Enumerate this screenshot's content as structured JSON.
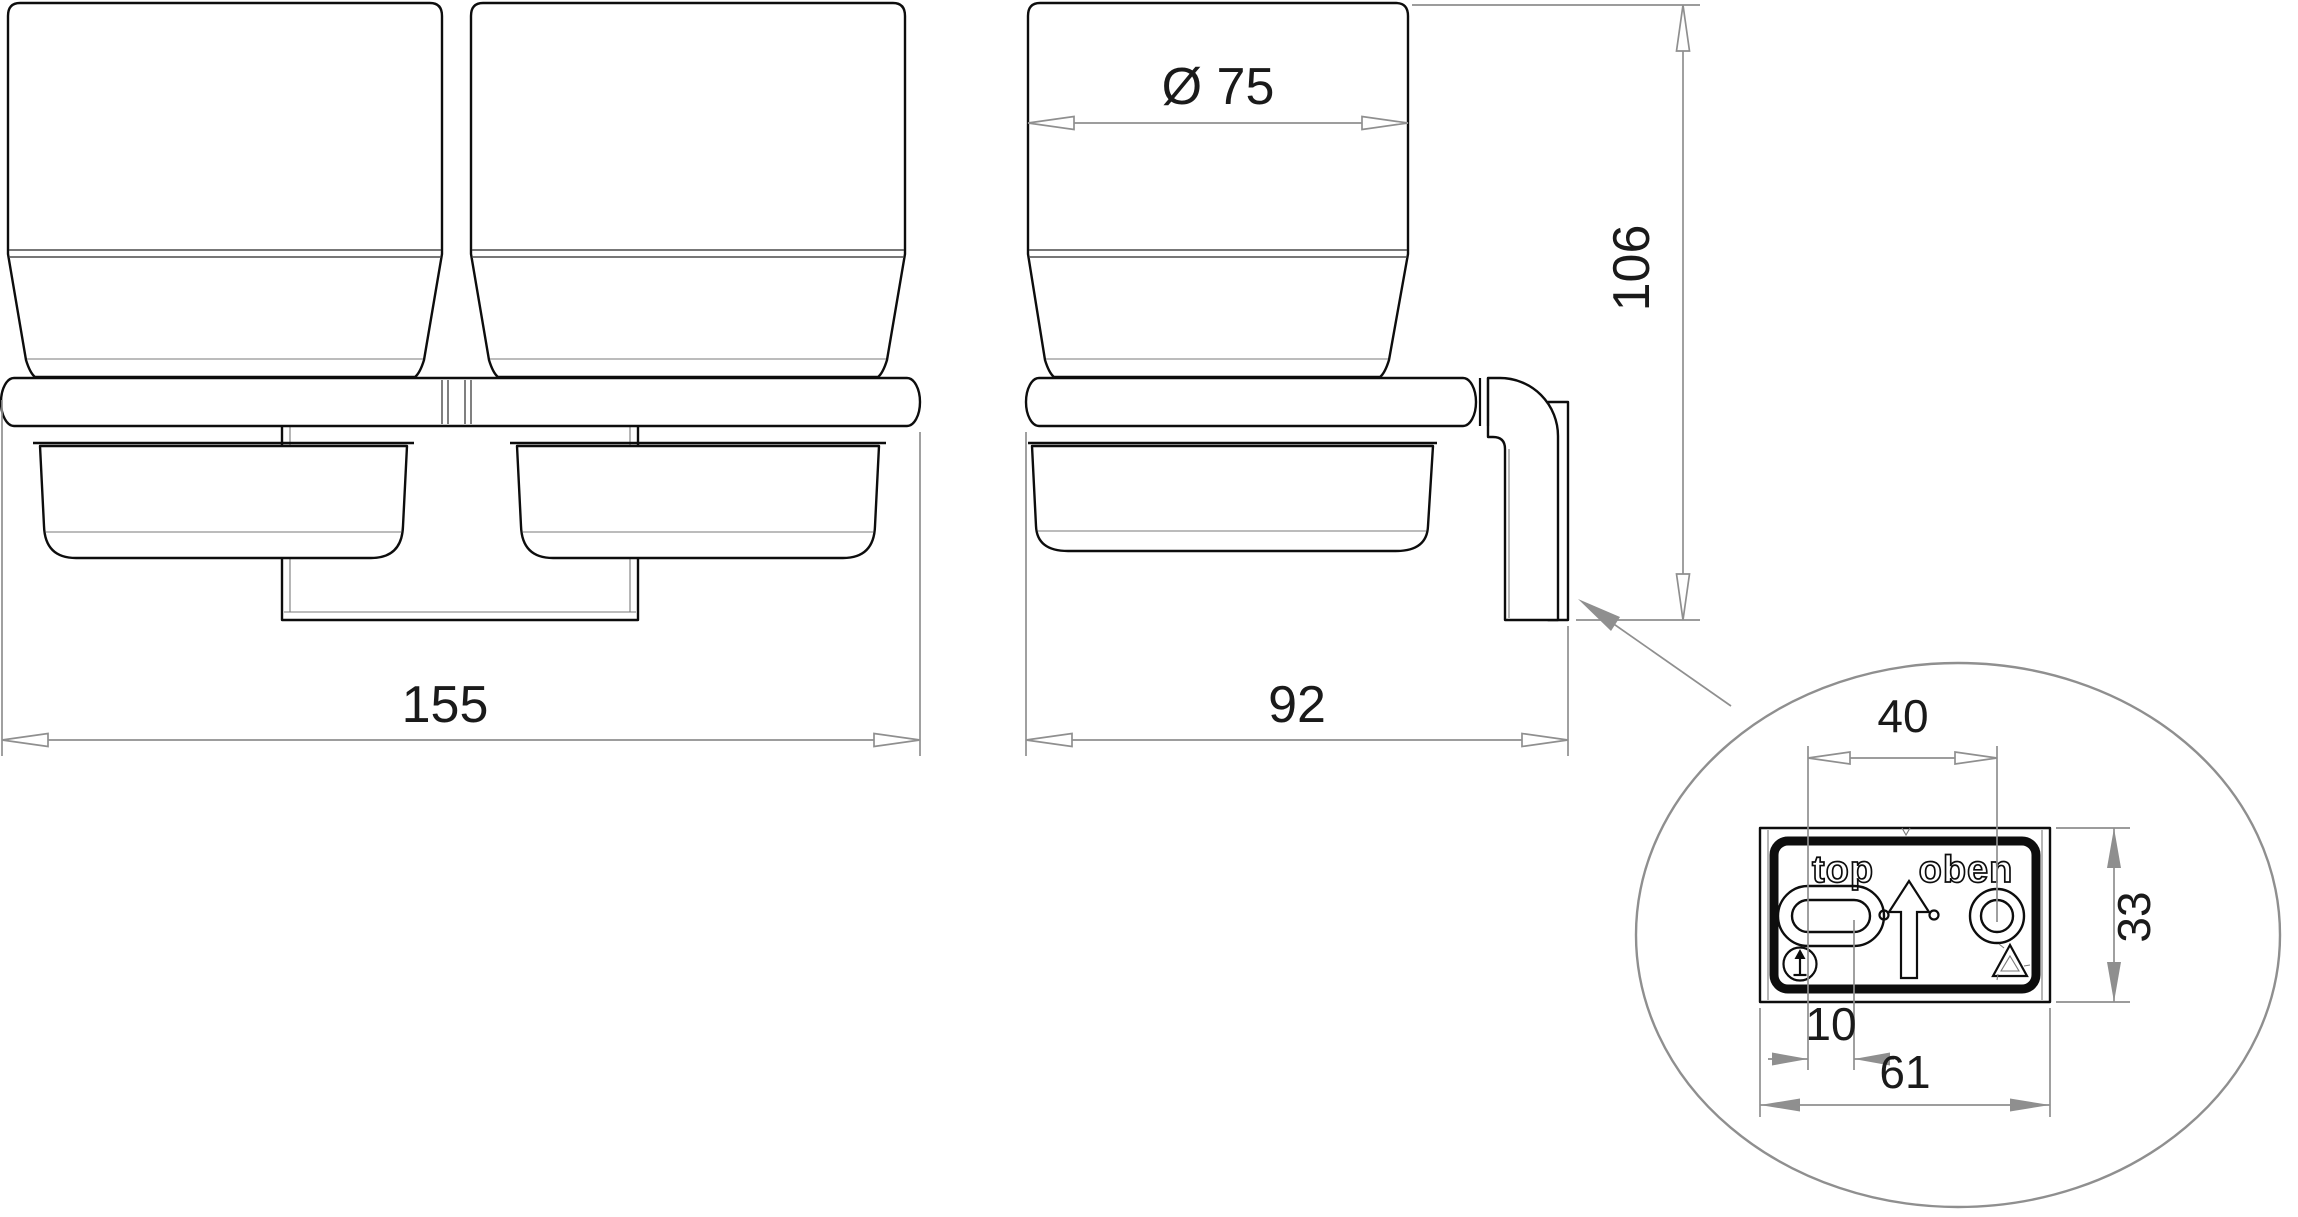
{
  "drawing": {
    "type": "technical-dimension-drawing",
    "subject": "double glass tumbler wall holder - front view, side view and mounting plate detail",
    "background_color": "#ffffff",
    "outline_color": "#0d0d0d",
    "dimension_color": "#8f8f8f",
    "text_color": "#1a1a1a"
  },
  "labels": {
    "front_width": "155",
    "cup_diameter": "Ø 75",
    "depth": "92",
    "height": "106",
    "hole_spacing": "40",
    "plate_height": "33",
    "slot_width": "10",
    "plate_width": "61",
    "plate_text_left": "top",
    "plate_text_right": "oben"
  },
  "chart_data": {
    "type": "table",
    "title": "Dimensions (mm)",
    "categories": [
      "overall width",
      "cup diameter",
      "depth from wall",
      "overall height",
      "mount hole spacing",
      "plate height",
      "slot width",
      "plate width"
    ],
    "values": [
      155,
      75,
      92,
      106,
      40,
      33,
      10,
      61
    ]
  }
}
